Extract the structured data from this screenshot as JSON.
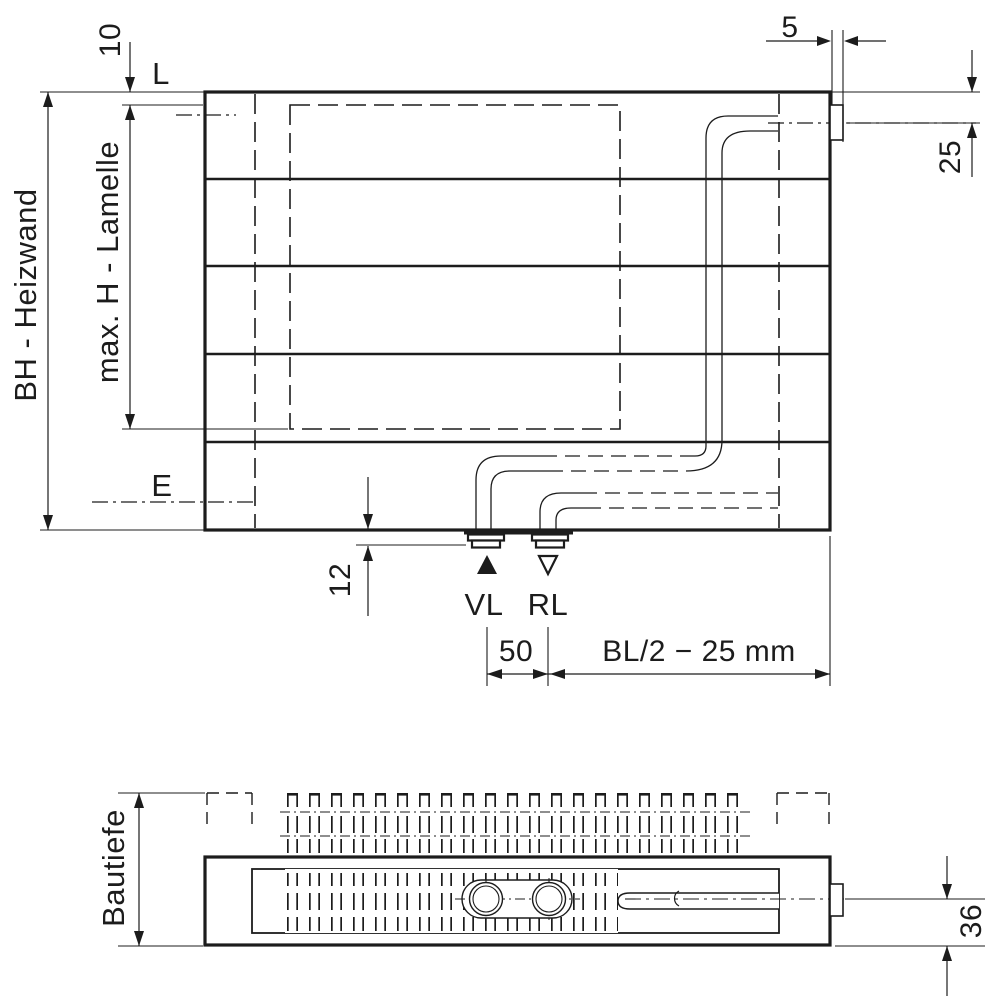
{
  "drawing": {
    "front_view": {
      "labels": {
        "top_gap": "10",
        "lamella_top_level": "L",
        "stub_width": "5",
        "connection_center_offset": "25",
        "build_height": "BH - Heizwand",
        "max_lamella_height": "max. H - Lamelle",
        "bottom_level": "E",
        "stub_protrusion": "12",
        "supply": "VL",
        "return": "RL",
        "connection_spacing": "50",
        "connection_position": "BL/2 − 25 mm"
      }
    },
    "plan_view": {
      "labels": {
        "build_depth": "Bautiefe",
        "pipe_axis_offset": "36"
      }
    },
    "style": {
      "line_color": "#1c1c1c",
      "background": "#ffffff"
    }
  }
}
